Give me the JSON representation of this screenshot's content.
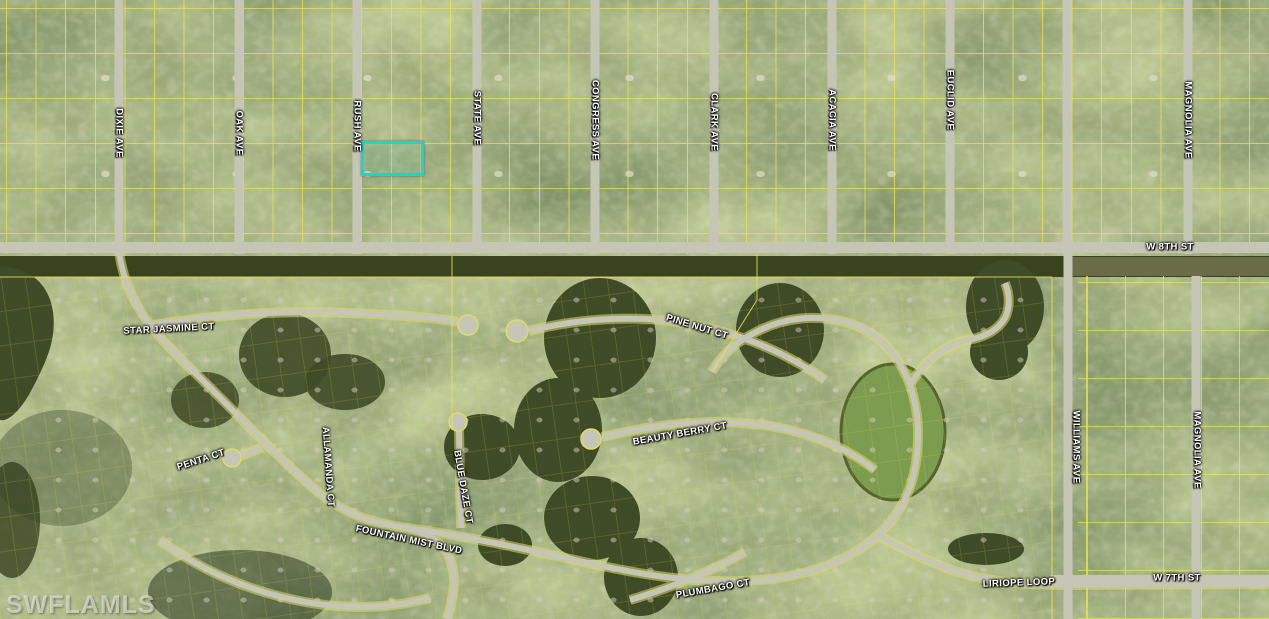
{
  "map": {
    "description": "aerial parcel map with MLS overlay",
    "watermark": "SWFLAMLS",
    "colors": {
      "parcel_line": "#e9e553",
      "subject_highlight": "#1fd3d3",
      "road": "#c6c6b6",
      "water": "#3f4a27",
      "algae_pond": "#7d9c4f"
    },
    "labels": {
      "dixie_ave": "DIXIE AVE",
      "oak_ave": "OAK AVE",
      "rush_ave": "RUSH AVE",
      "state_ave": "STATE AVE",
      "congress_ave": "CONGRESS AVE",
      "clark_ave": "CLARK AVE",
      "acacia_ave": "ACACIA AVE",
      "euclid_ave": "EUCLID AVE",
      "magnolia_ave_north": "MAGNOLIA AVE",
      "w_8th_st": "W 8TH ST",
      "star_jasmine_ct": "STAR JASMINE CT",
      "pine_nut_ct": "PINE NUT CT",
      "beauty_berry_ct": "BEAUTY BERRY CT",
      "penta_ct": "PENTA CT",
      "allamanda_ct": "ALLAMANDA CT",
      "blue_daze_ct": "BLUE DAZE CT",
      "fountain_mist_blvd": "FOUNTAIN MIST BLVD",
      "williams_ave": "WILLIAMS AVE",
      "magnolia_ave_south": "MAGNOLIA AVE",
      "plumbago_ct": "PLUMBAGO CT",
      "liriope_loop": "LIRIOPE LOOP",
      "w_7th_st": "W 7TH ST"
    }
  }
}
